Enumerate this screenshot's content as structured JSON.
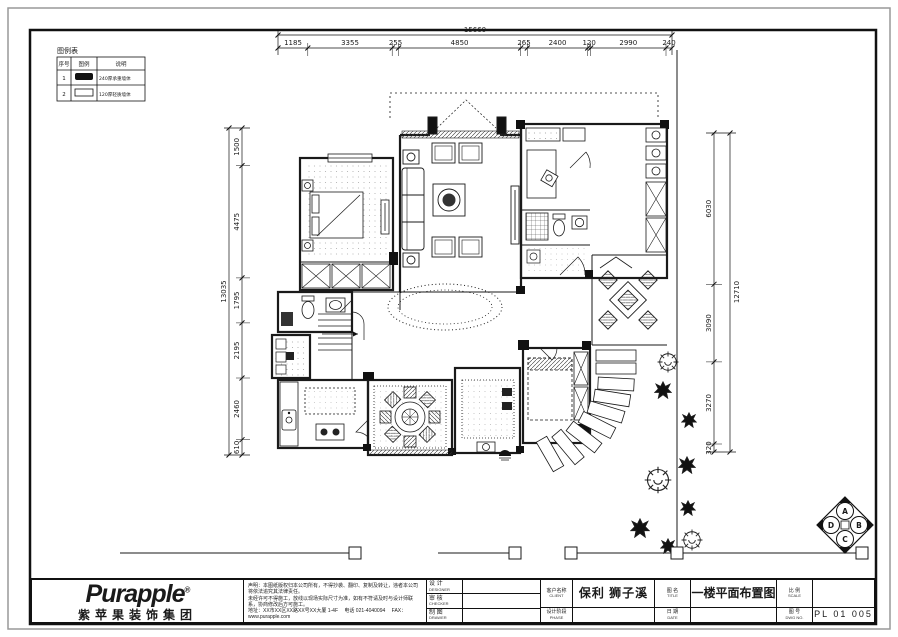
{
  "legend": {
    "title": "图例表",
    "col_no": "序号",
    "col_symbol": "图例",
    "col_desc": "说明",
    "rows": [
      {
        "no": "1",
        "desc": "240厚承重墙体"
      },
      {
        "no": "2",
        "desc": "120厚轻质墙体"
      }
    ]
  },
  "dims": {
    "top": {
      "total": "15660",
      "seg": [
        "1185",
        "3355",
        "255",
        "4850",
        "265",
        "2400",
        "120",
        "2990",
        "240"
      ]
    },
    "left": {
      "total": "13035",
      "seg": [
        "1500",
        "4475",
        "1795",
        "2195",
        "2460",
        "610"
      ]
    },
    "right": {
      "total": "12710",
      "seg": [
        "6030",
        "3090",
        "3270",
        "320"
      ]
    }
  },
  "compass": {
    "top": "A",
    "right": "B",
    "bottom": "C",
    "left": "D"
  },
  "title_block": {
    "logo": "Purapple",
    "reg": "®",
    "company": "紫苹果装饰集团",
    "disclaimer1": "声明：本图纸版权归本公司所有，不得抄袭、翻印、复制及转让，违者本公司将依法追究其法律责任。",
    "disclaimer2": "未经许可不得施工，放线以现场实际尺寸为准，如有不符请及时与设计师联系，协商修改后方可施工。",
    "address": "地址：XX市XX区XX路XX号XX大厦 1-4F　 电话 021-4040094 　FAX：www.purapple.com",
    "sign_rows": [
      {
        "cn": "设 计",
        "en": "DESIGNER"
      },
      {
        "cn": "审 核",
        "en": "CHECKER"
      },
      {
        "cn": "制 图",
        "en": "DRAWER"
      }
    ],
    "client_label_cn": "客户名称",
    "client_label_en": "CLIENT",
    "stage_label_cn": "设计阶段",
    "stage_label_en": "PHASE",
    "project_name": "保利 狮子溪",
    "name_label_cn": "图 名",
    "name_label_en": "TITLE",
    "date_label_cn": "日 期",
    "date_label_en": "DATE",
    "drawing_title": "一楼平面布置图",
    "scale_label_cn": "比 例",
    "scale_label_en": "SCALE",
    "no_label_cn": "图 号",
    "no_label_en": "DWG NO.",
    "drawing_no": "PL 01 005"
  }
}
